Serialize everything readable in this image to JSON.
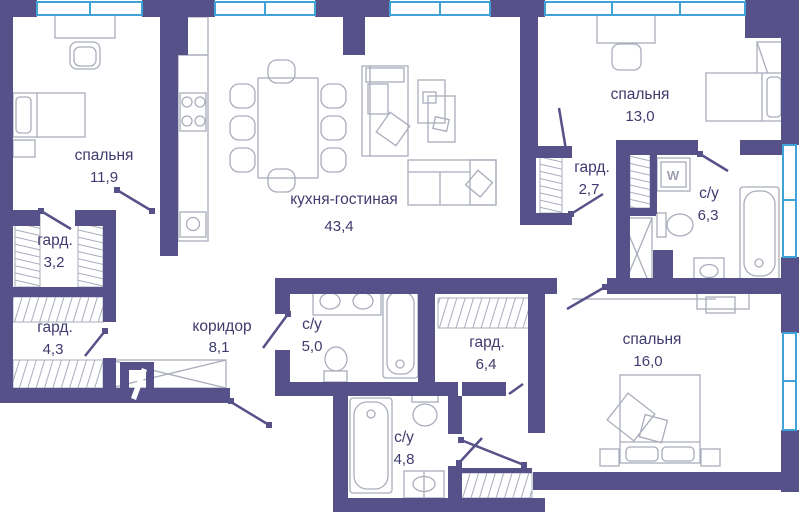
{
  "plan": {
    "type": "apartment-floor-plan",
    "colors": {
      "wall": "#575189",
      "window": "#3fa3d8",
      "furniture": "#a9adbb",
      "label": "#3f3b6e",
      "background": "#ffffff"
    },
    "rooms": [
      {
        "id": "bedroom-1",
        "name": "спальня",
        "area": "11,9"
      },
      {
        "id": "wardrobe-1",
        "name": "гард.",
        "area": "3,2"
      },
      {
        "id": "wardrobe-2",
        "name": "гард.",
        "area": "4,3"
      },
      {
        "id": "kitchen-living",
        "name": "кухня-гостиная",
        "area": "43,4"
      },
      {
        "id": "corridor",
        "name": "коридор",
        "area": "8,1"
      },
      {
        "id": "bathroom-1",
        "name": "с/у",
        "area": "5,0"
      },
      {
        "id": "wardrobe-3",
        "name": "гард.",
        "area": "2,7"
      },
      {
        "id": "bedroom-2",
        "name": "спальня",
        "area": "13,0"
      },
      {
        "id": "bathroom-2",
        "name": "с/у",
        "area": "6,3"
      },
      {
        "id": "wardrobe-4",
        "name": "гард.",
        "area": "6,4"
      },
      {
        "id": "bedroom-3",
        "name": "спальня",
        "area": "16,0"
      },
      {
        "id": "bathroom-3",
        "name": "с/у",
        "area": "4,8"
      }
    ],
    "appliances": {
      "washer_label": "W"
    }
  }
}
